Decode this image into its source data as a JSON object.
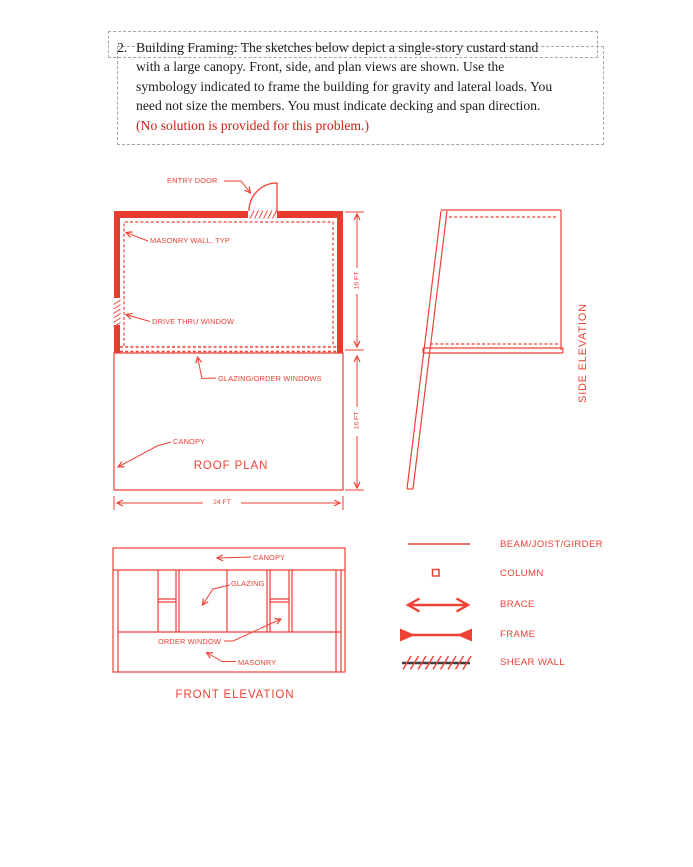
{
  "problem": {
    "number": "2.",
    "lines": [
      "Building Framing:  The sketches below depict a single-story custard stand",
      "with a large canopy.  Front, side, and plan views are shown.  Use the",
      "symbology indicated to frame the building for gravity and lateral loads.  You",
      "need not size the members.  You must indicate decking and span direction.",
      "(No solution is provided for this problem.)"
    ]
  },
  "roof_plan": {
    "title": "ROOF PLAN",
    "labels": {
      "entry_door": "ENTRY DOOR",
      "masonry_wall": "MASONRY WALL, TYP",
      "drive_thru_window": "DRIVE THRU WINDOW",
      "glazing_order_windows": "GLAZING/ORDER WINDOWS",
      "canopy": "CANOPY"
    },
    "dimensions": {
      "width": "24 FT",
      "depth_building": "16 FT",
      "depth_canopy": "16 FT"
    }
  },
  "side_elevation": {
    "title": "SIDE ELEVATION"
  },
  "front_elevation": {
    "title": "FRONT ELEVATION",
    "labels": {
      "canopy": "CANOPY",
      "glazing": "GLAZING",
      "order_window": "ORDER WINDOW",
      "masonry": "MASONRY"
    }
  },
  "legend": {
    "items": [
      {
        "symbol": "beam-line",
        "label": "BEAM/JOIST/GIRDER"
      },
      {
        "symbol": "column-square",
        "label": "COLUMN"
      },
      {
        "symbol": "brace-double-arrow",
        "label": "BRACE"
      },
      {
        "symbol": "frame-solid-arrowheads",
        "label": "FRAME"
      },
      {
        "symbol": "shear-wall-hatched-line",
        "label": "SHEAR WALL"
      }
    ]
  },
  "colors": {
    "drawing_red": "#ee4135",
    "statement_red": "#cc1f14",
    "dash_gray": "#a6a6a6",
    "shear_wall_dark": "#3f3f3f",
    "body_text": "#1d1d1d"
  }
}
